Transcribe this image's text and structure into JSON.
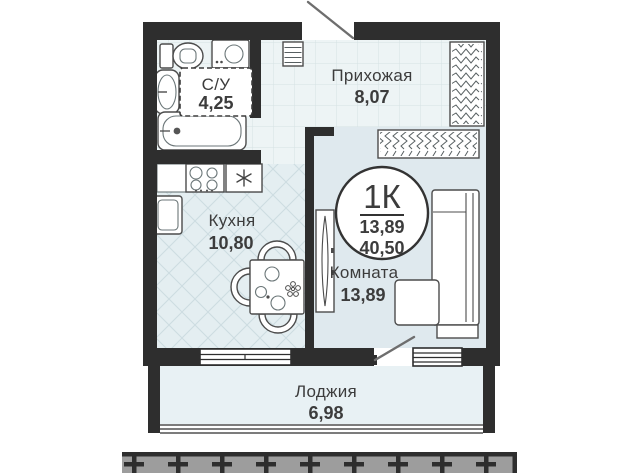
{
  "floorplan": {
    "badge": {
      "room_type": "1К",
      "living_area": "13,89",
      "total_area": "40,50"
    },
    "rooms": {
      "bathroom": {
        "label": "С/У",
        "area": "4,25"
      },
      "hallway": {
        "label": "Прихожая",
        "area": "8,07"
      },
      "kitchen": {
        "label": "Кухня",
        "area": "10,80"
      },
      "living_room": {
        "label": "Комната",
        "area": "13,89"
      },
      "loggia": {
        "label": "Лоджия",
        "area": "6,98"
      }
    },
    "colors": {
      "wall": "#2e2e2e",
      "floor_grid": "#edf4f5",
      "floor_kitchen": "#e4eef1",
      "floor_room": "#dfe9ee",
      "floor_loggia": "#e8f1f4",
      "facade": "#9d9d9d",
      "text": "#3c3c3c"
    }
  }
}
